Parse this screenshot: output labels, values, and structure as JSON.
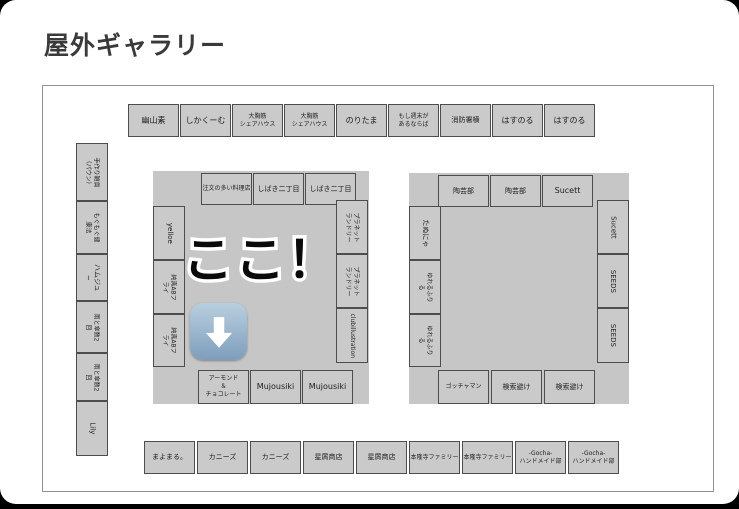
{
  "page": {
    "title": "屋外ギャラリー"
  },
  "overlay": {
    "here_text": "ここ！",
    "arrow_icon": "down-arrow-emoji"
  },
  "colors": {
    "booth_fill": "#cacaca",
    "booth_border": "#4d4d4d",
    "island_fill": "#c6c6c6",
    "map_border": "#919191",
    "title_color": "#3a3a3a",
    "arrow_blue_top": "#b9cfdf",
    "arrow_blue_bottom": "#7e9ebc",
    "arrow_glyph": "#ffffff"
  },
  "map": {
    "top_row": [
      "幽山素",
      "しかくーむ",
      "大胸筋\nシェアハウス",
      "大胸筋\nシェアハウス",
      "のりたま",
      "もし週末が\nあるならば",
      "消防署横",
      "はすのる",
      "はすのる"
    ],
    "left_column": [
      "手作り雑貨\n（パウン）",
      "もぐもぐ健康法",
      "ハムジュ~",
      "雨と傘数2回",
      "雨と傘数2回",
      "Lily"
    ],
    "left_island": {
      "top": [
        "注文の多い料理店",
        "しばき二丁目",
        "しばき二丁目"
      ],
      "left": [
        "yelloe",
        "純真ABフライ",
        "純真ABフライ"
      ],
      "right": [
        "プラネット\nランドリー",
        "プラネット\nランドリー",
        "clubillustration"
      ],
      "bottom": [
        "アーモンド\n＆\nチョコレート",
        "Mujousiki",
        "Mujousiki"
      ]
    },
    "right_island": {
      "top": [
        "陶芸部",
        "陶芸部",
        "Sucett"
      ],
      "left": [
        "たぬにゃ",
        "ゆれるふりる",
        "ゆれるふりる"
      ],
      "right": [
        "Sucett",
        "SEEDS",
        "SEEDS"
      ],
      "bottom": [
        "ゴッチャマン",
        "検索避け",
        "検索避け"
      ]
    },
    "bottom_row": [
      "まよまる。",
      "カニーズ",
      "カニーズ",
      "星屑商店",
      "星屑商店",
      "本隆寺ファミリー",
      "本隆寺ファミリー",
      "-Gocha-\nハンドメイド部",
      "-Gocha-\nハンドメイド部"
    ]
  }
}
